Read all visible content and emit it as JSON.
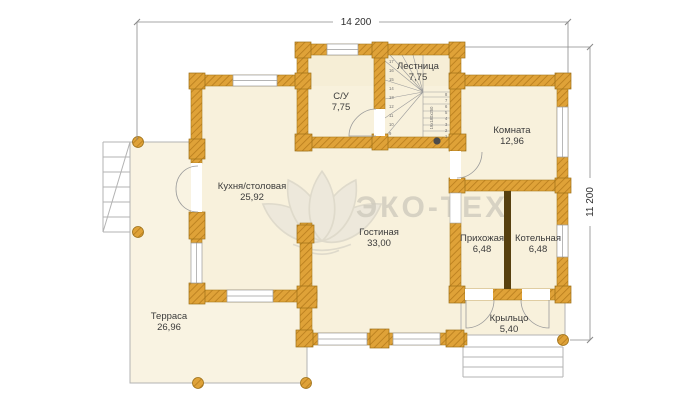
{
  "plan": {
    "dimension_width": "14 200",
    "dimension_height": "11 200",
    "watermark": "ЭКО-ТЕХ",
    "rooms": {
      "bathroom": {
        "name": "С/У",
        "area": "7,75"
      },
      "staircase": {
        "name": "Лестница",
        "area": "7,75"
      },
      "room": {
        "name": "Комната",
        "area": "12,96"
      },
      "kitchen": {
        "name": "Кухня/столовая",
        "area": "25,92"
      },
      "living": {
        "name": "Гостиная",
        "area": "33,00"
      },
      "hallway": {
        "name": "Прихожая",
        "area": "6,48"
      },
      "boiler": {
        "name": "Котельная",
        "area": "6,48"
      },
      "terrace": {
        "name": "Терраса",
        "area": "26,96"
      },
      "porch": {
        "name": "Крыльцо",
        "area": "5,40"
      }
    },
    "stair_detail": {
      "annotation": "19x180x250",
      "left_steps": [
        "17",
        "16",
        "15",
        "14",
        "13",
        "12",
        "11",
        "10",
        "9"
      ],
      "right_steps": [
        "8",
        "7",
        "6",
        "5",
        "4",
        "3",
        "2",
        "1"
      ]
    },
    "colors": {
      "wall": "#dfa238",
      "wall_hatch": "#b97e1e",
      "floor": "#f8f1dc",
      "dark_partition": "#57400f",
      "line_gray": "#9b9b9b",
      "watermark_gray": "#cfcbbe"
    }
  }
}
